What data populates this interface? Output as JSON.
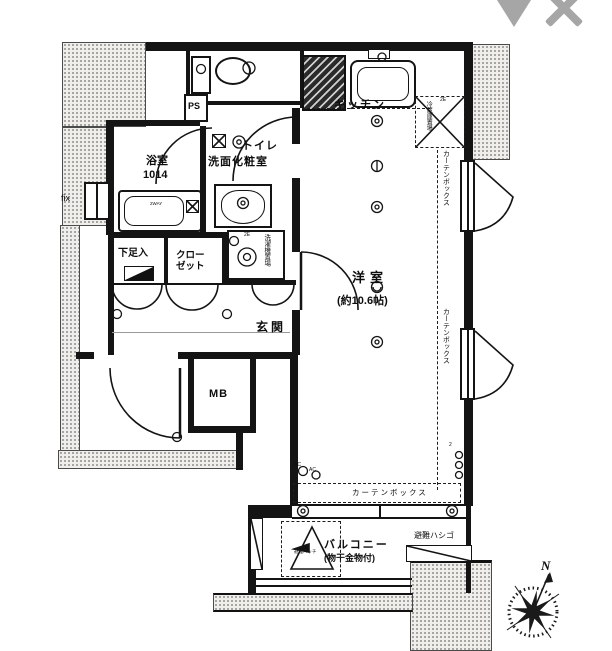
{
  "window_controls": {
    "dropdown_icon": "",
    "close_icon": ""
  },
  "labels": {
    "toilet": "トイレ",
    "ps": "PS",
    "kitchen": "キッチン",
    "fridge_space": "冷蔵庫置場",
    "outlet_2e": "2E",
    "bath": "浴室",
    "bath_size": "1014",
    "bathtub_note": "2WAY",
    "washroom": "洗面化粧室",
    "laundry_space": "洗濯機置場",
    "shoe_box": "下足入",
    "closet": "クロー\nゼット",
    "entrance": "玄関",
    "fix_window": "fix",
    "meter_box": "MB",
    "main_room": "洋室",
    "main_room_size": "(約10.6帖)",
    "curtain_box": "カーテンボックス",
    "ac": "AC",
    "two": "2",
    "balcony": "バルコニー",
    "balcony_note": "(物干金物付)",
    "evac_hatch": "避難ハッチ",
    "evac_ladder": "避難ハシゴ",
    "north": "N"
  }
}
